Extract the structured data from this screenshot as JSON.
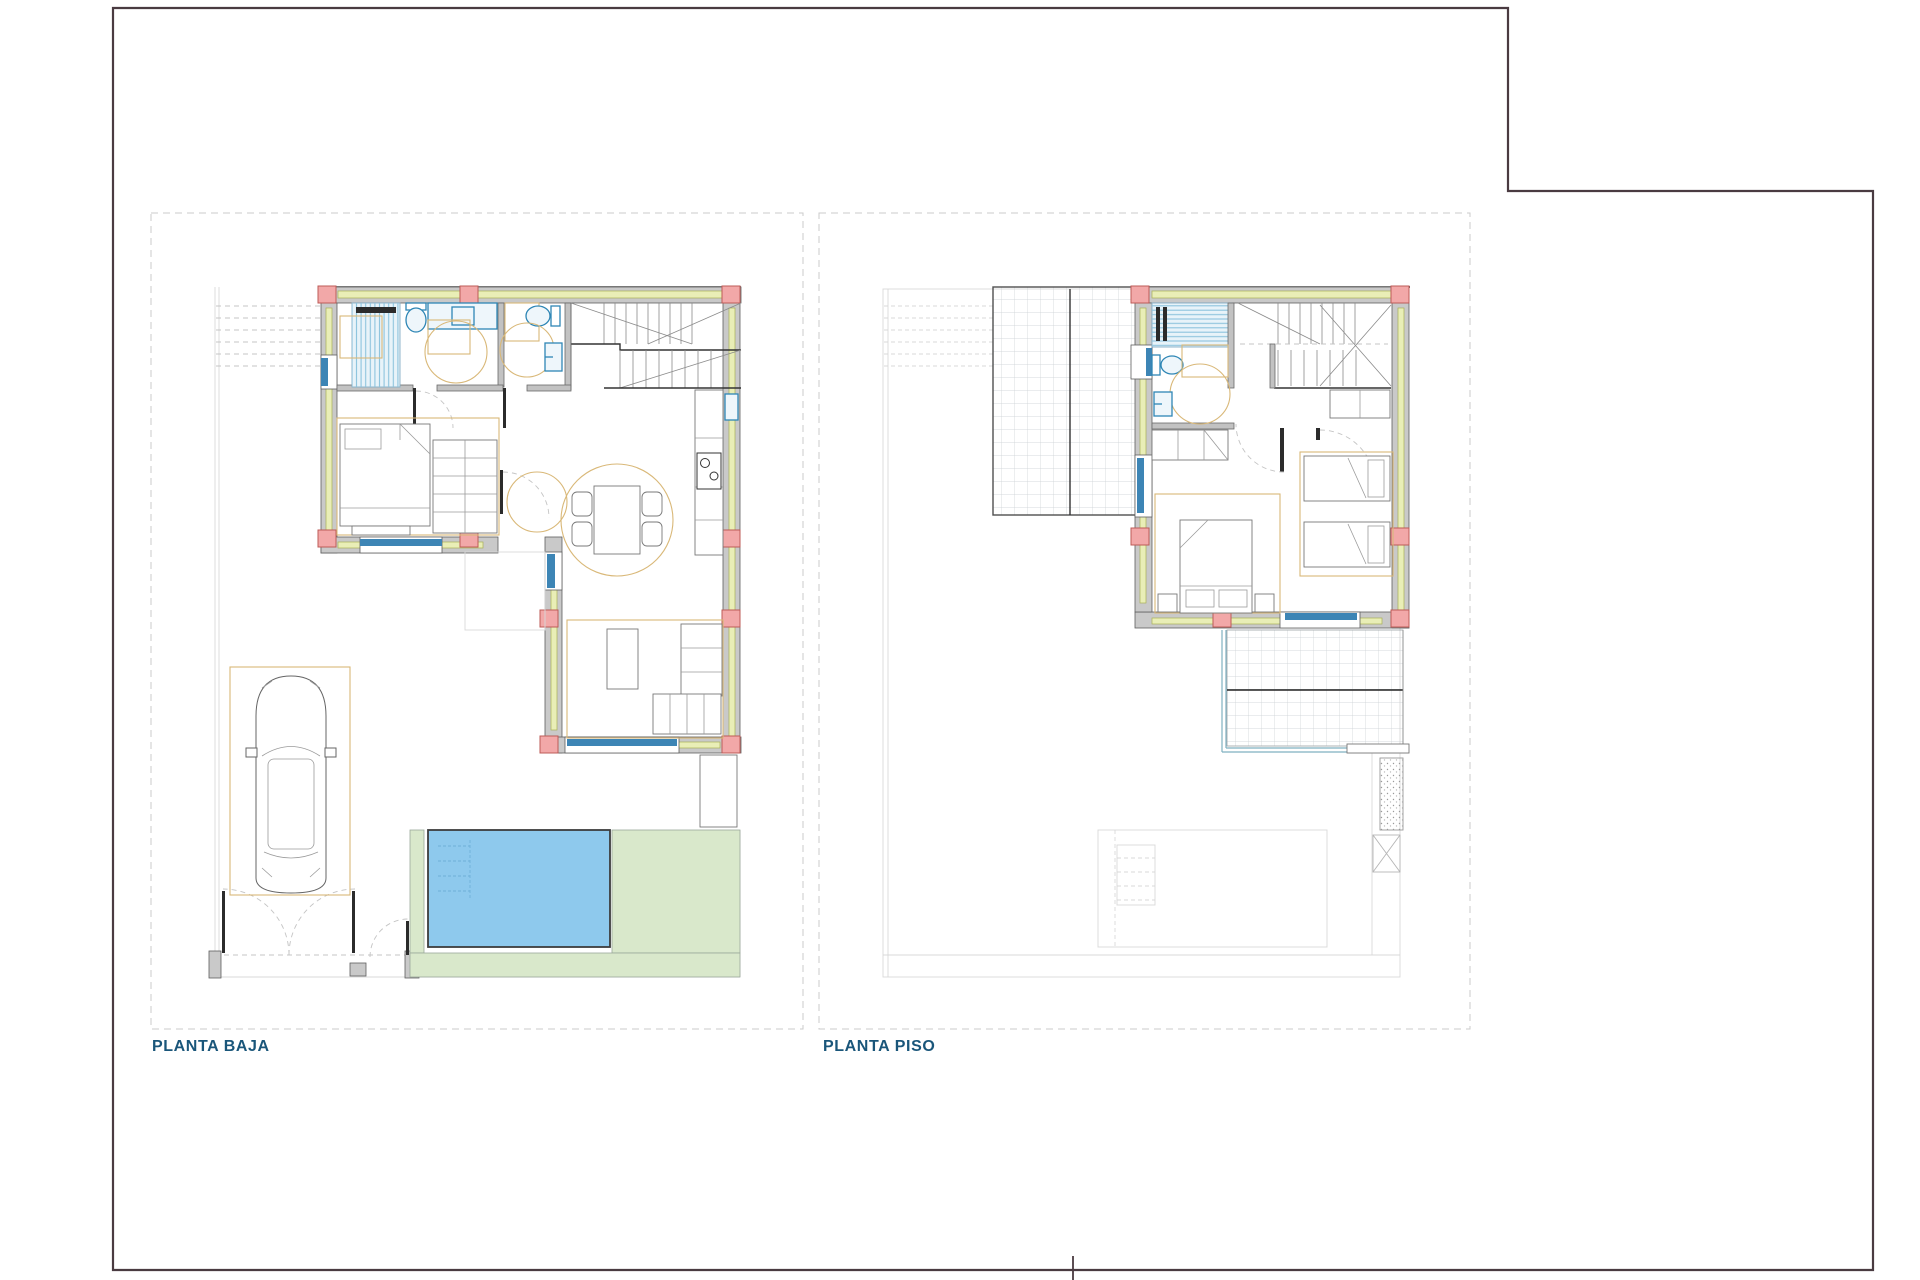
{
  "labels": {
    "planta_baja": "PLANTA BAJA",
    "planta_piso": "PLANTA PISO"
  },
  "colors": {
    "border": "#4a3b41",
    "panel_dash": "#cbcbcb",
    "label_text": "#1a567a",
    "wall_fill": "#c9c9c9",
    "wall_edge": "#5f5f5f",
    "insulation": "#e9eeb6",
    "insulation_edge": "#a8ae57",
    "column_fill": "#f2a8a8",
    "column_edge": "#bd5b57",
    "window_blue": "#3d85b5",
    "fixture_blue": "#2e86b5",
    "fixture_fill": "#eef6fb",
    "stripe_blue": "#8cc3dd",
    "shower_fill": "#e8f3f9",
    "furniture_tan": "#d9b878",
    "pool_fill": "#8ec9ed",
    "pool_edge": "#3c3c3c",
    "deck_green": "#d9e8cb",
    "deck_edge": "#9aa89a",
    "faint": "#d9d9d9",
    "grid_line": "#c9ced2",
    "terrace_edge": "#4f4f4f",
    "balcony_teal": "#7fb0c0",
    "dash_gray": "#c4c4c4",
    "door_dark": "#2b2b2b"
  }
}
